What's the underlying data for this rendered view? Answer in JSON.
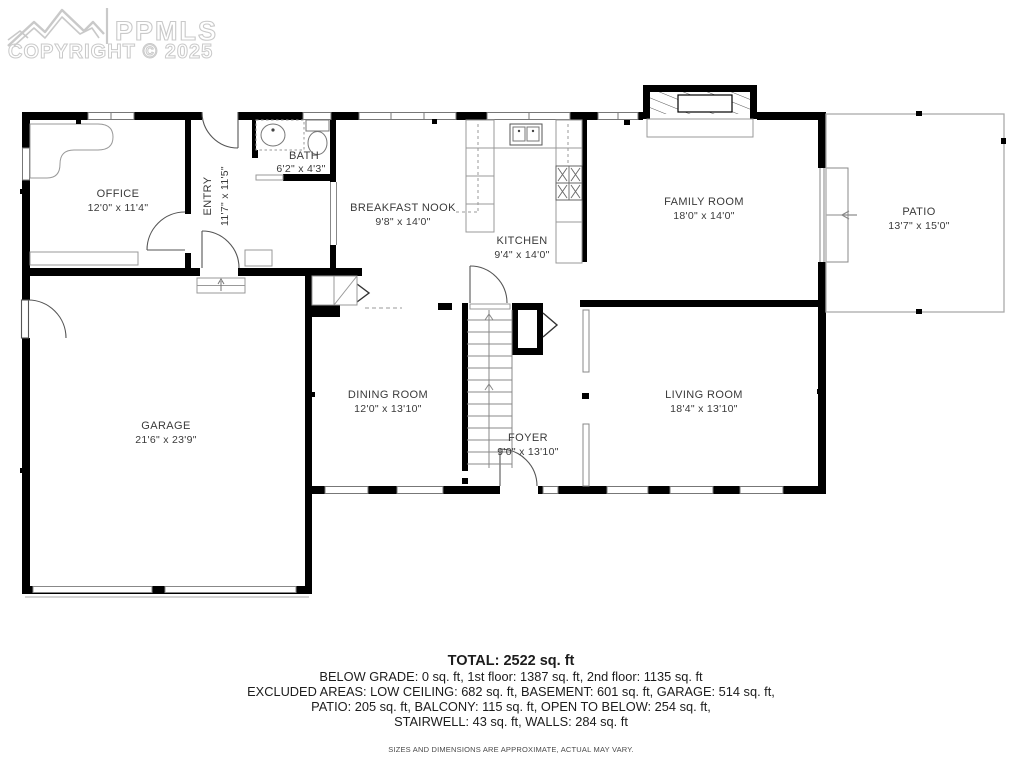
{
  "watermark": {
    "brand": "PPMLS",
    "copyright": "COPYRIGHT © 2025"
  },
  "rooms": [
    {
      "name": "OFFICE",
      "dims": "12'0\" x 11'4\""
    },
    {
      "name": "ENTRY",
      "dims": "11'7\" x 11'5\""
    },
    {
      "name": "BATH",
      "dims": "6'2\" x 4'3\""
    },
    {
      "name": "BREAKFAST NOOK",
      "dims": "9'8\" x 14'0\""
    },
    {
      "name": "KITCHEN",
      "dims": "9'4\" x 14'0\""
    },
    {
      "name": "FAMILY ROOM",
      "dims": "18'0\" x 14'0\""
    },
    {
      "name": "PATIO",
      "dims": "13'7\" x 15'0\""
    },
    {
      "name": "GARAGE",
      "dims": "21'6\" x 23'9\""
    },
    {
      "name": "DINING ROOM",
      "dims": "12'0\" x 13'10\""
    },
    {
      "name": "FOYER",
      "dims": "9'0\" x 13'10\""
    },
    {
      "name": "LIVING ROOM",
      "dims": "18'4\" x 13'10\""
    }
  ],
  "summary": {
    "total": "TOTAL: 2522 sq. ft",
    "line1": "BELOW GRADE: 0 sq. ft, 1st floor: 1387 sq. ft, 2nd floor: 1135 sq. ft",
    "line2": "EXCLUDED AREAS: LOW CEILING: 682 sq. ft, BASEMENT: 601 sq. ft, GARAGE: 514 sq. ft,",
    "line3": "PATIO: 205 sq. ft, BALCONY: 115 sq. ft, OPEN TO BELOW: 254 sq. ft,",
    "line4": "STAIRWELL: 43 sq. ft, WALLS: 284 sq. ft",
    "disclaimer": "SIZES AND DIMENSIONS ARE APPROXIMATE, ACTUAL MAY VARY."
  },
  "colors": {
    "wall": "#000000",
    "thin_line": "#999999",
    "label": "#3a3a3a",
    "watermark": "#c9c9c9"
  }
}
